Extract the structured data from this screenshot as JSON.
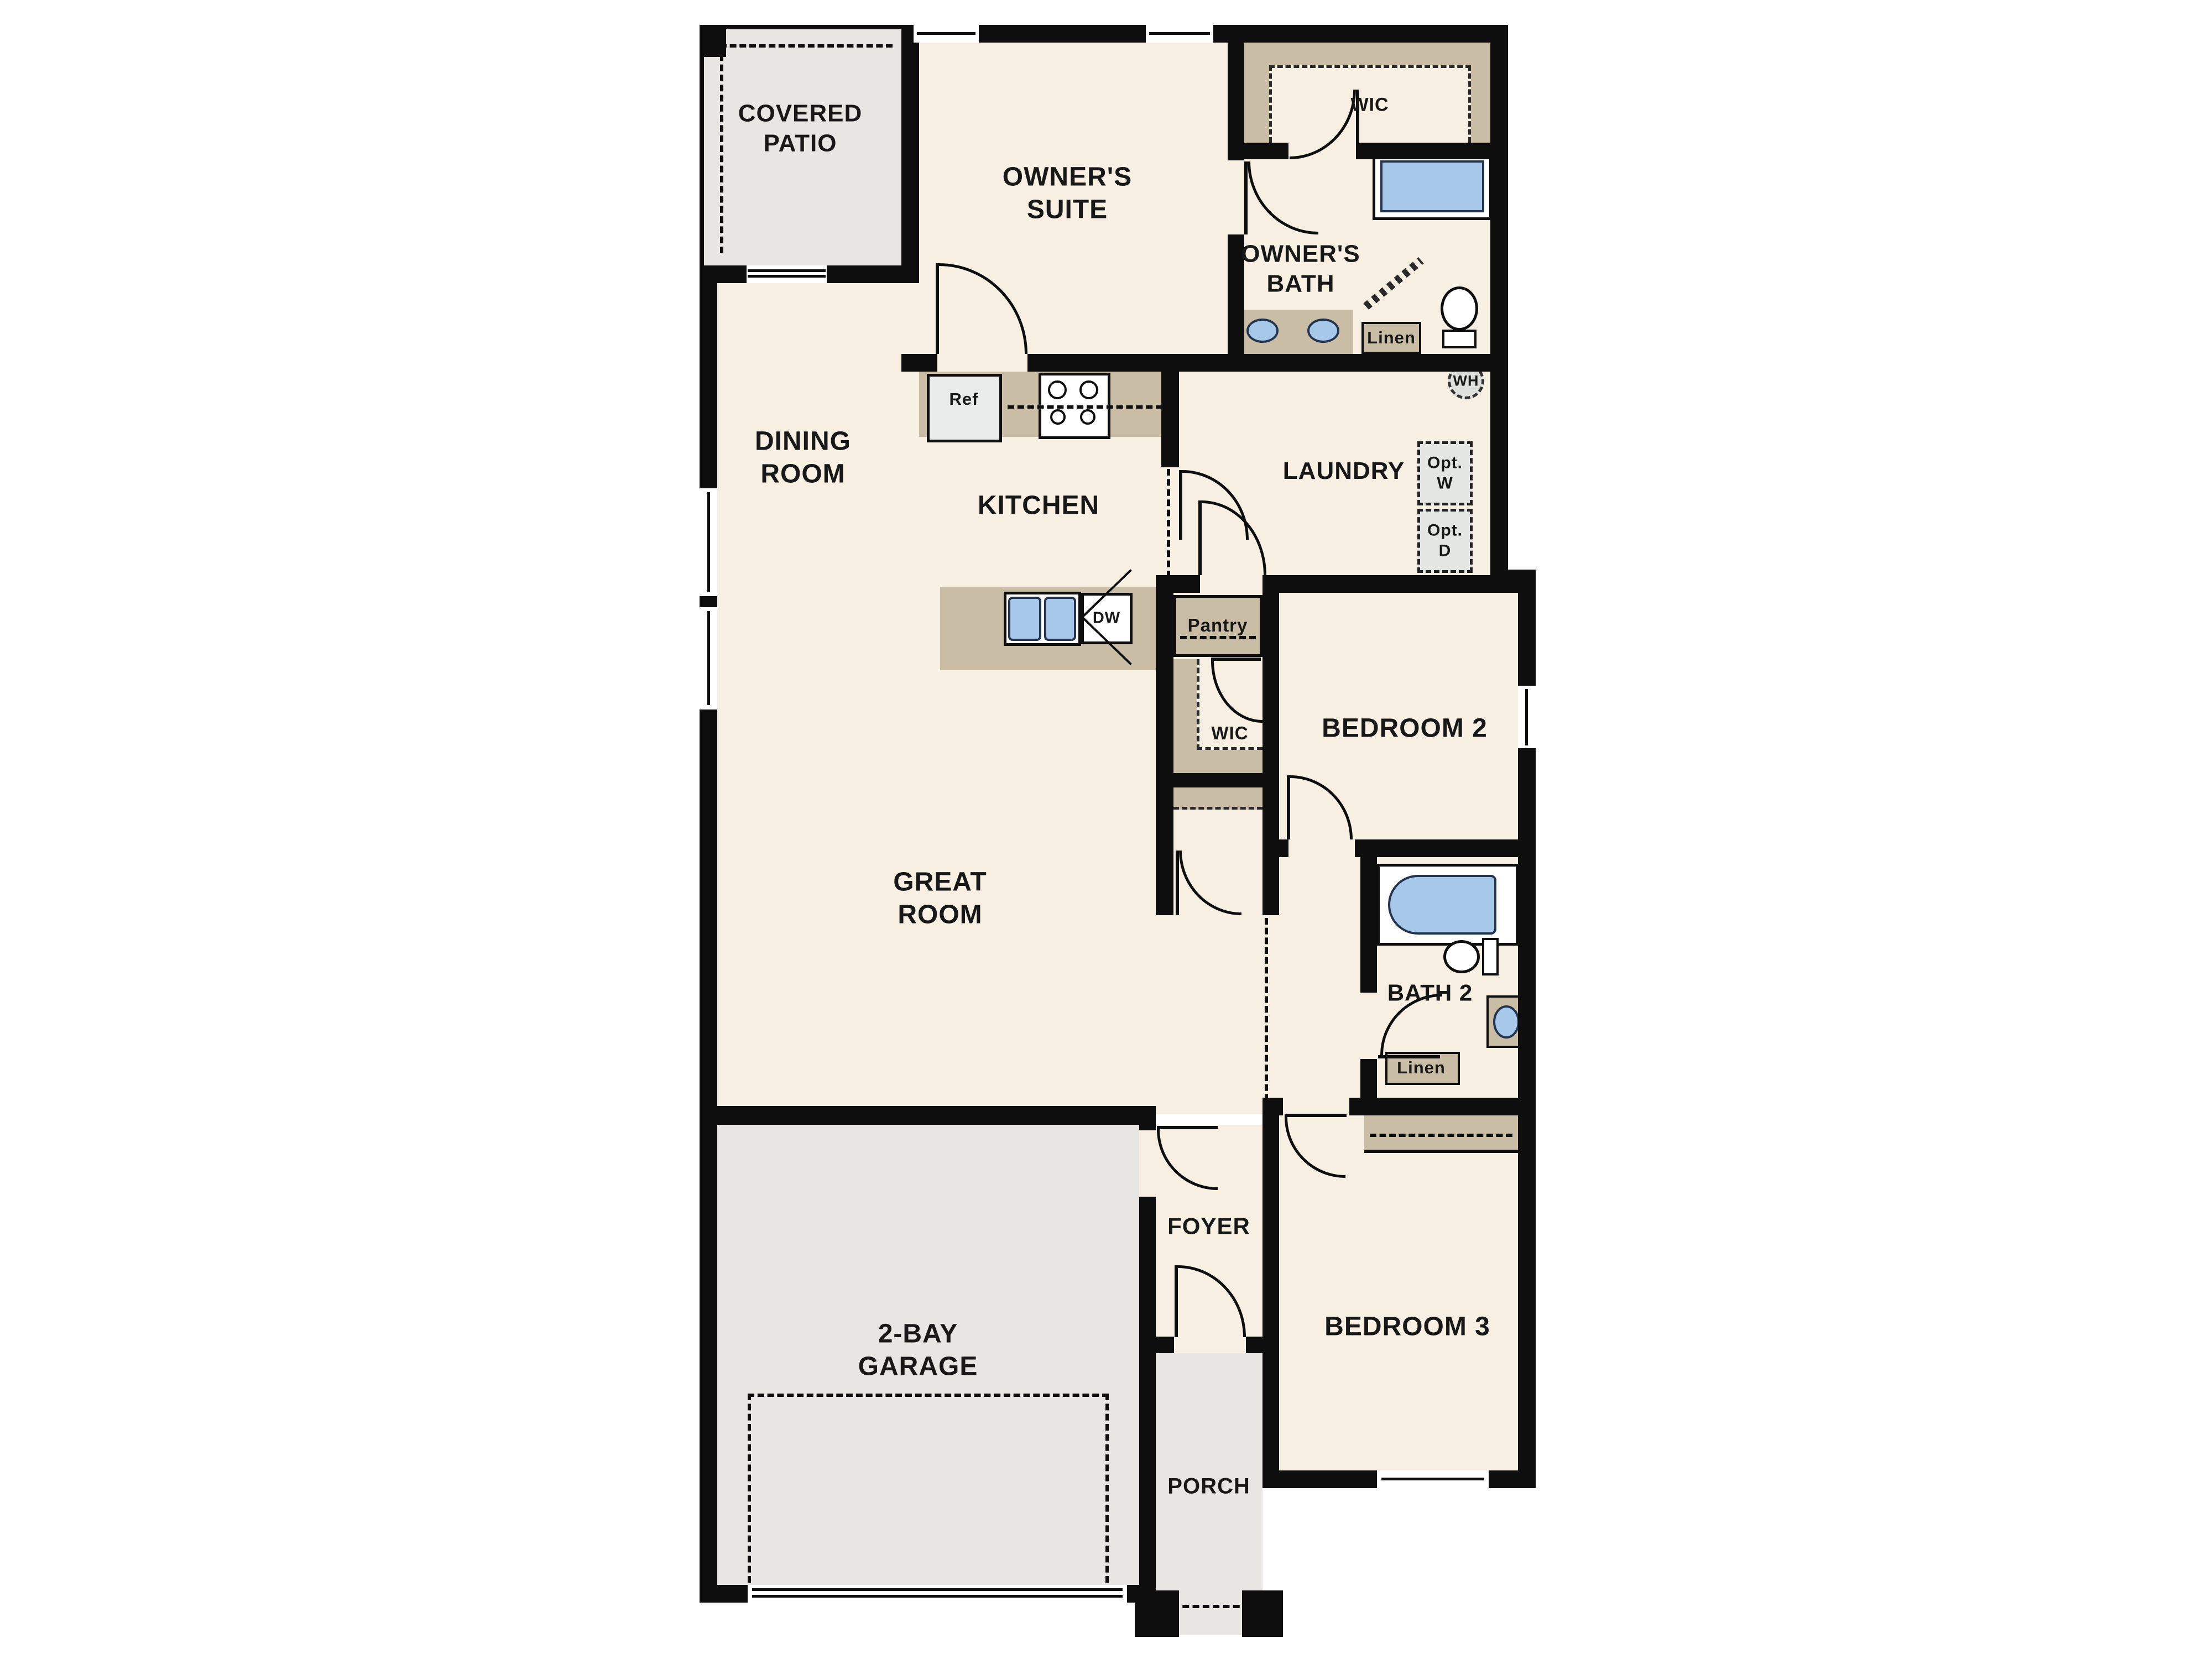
{
  "colors": {
    "wall": "#0e0e0e",
    "floor": "#f6efe2",
    "outdoor": "#e7e6e3",
    "appliance": "#e9eaea",
    "counter": "#c9bda6",
    "water": "#a7c8e8",
    "text": "#181818"
  },
  "rooms": {
    "covered_patio": "COVERED PATIO",
    "owners_suite": "OWNER'S SUITE",
    "owners_wic": "WIC",
    "owners_bath": "OWNER'S BATH",
    "dining_room": "DINING ROOM",
    "kitchen": "KITCHEN",
    "laundry": "LAUNDRY",
    "bedroom2": "BEDROOM 2",
    "bedroom2_wic": "WIC",
    "great_room": "GREAT ROOM",
    "bath2": "BATH 2",
    "bedroom3": "BEDROOM 3",
    "foyer": "FOYER",
    "garage": "2-BAY GARAGE",
    "porch": "PORCH"
  },
  "fixtures": {
    "refrigerator": "Ref",
    "dishwasher": "DW",
    "pantry": "Pantry",
    "owners_linen": "Linen",
    "bath2_linen": "Linen",
    "water_heater": "WH",
    "optional_washer": "Opt. W",
    "optional_dryer": "Opt. D"
  }
}
